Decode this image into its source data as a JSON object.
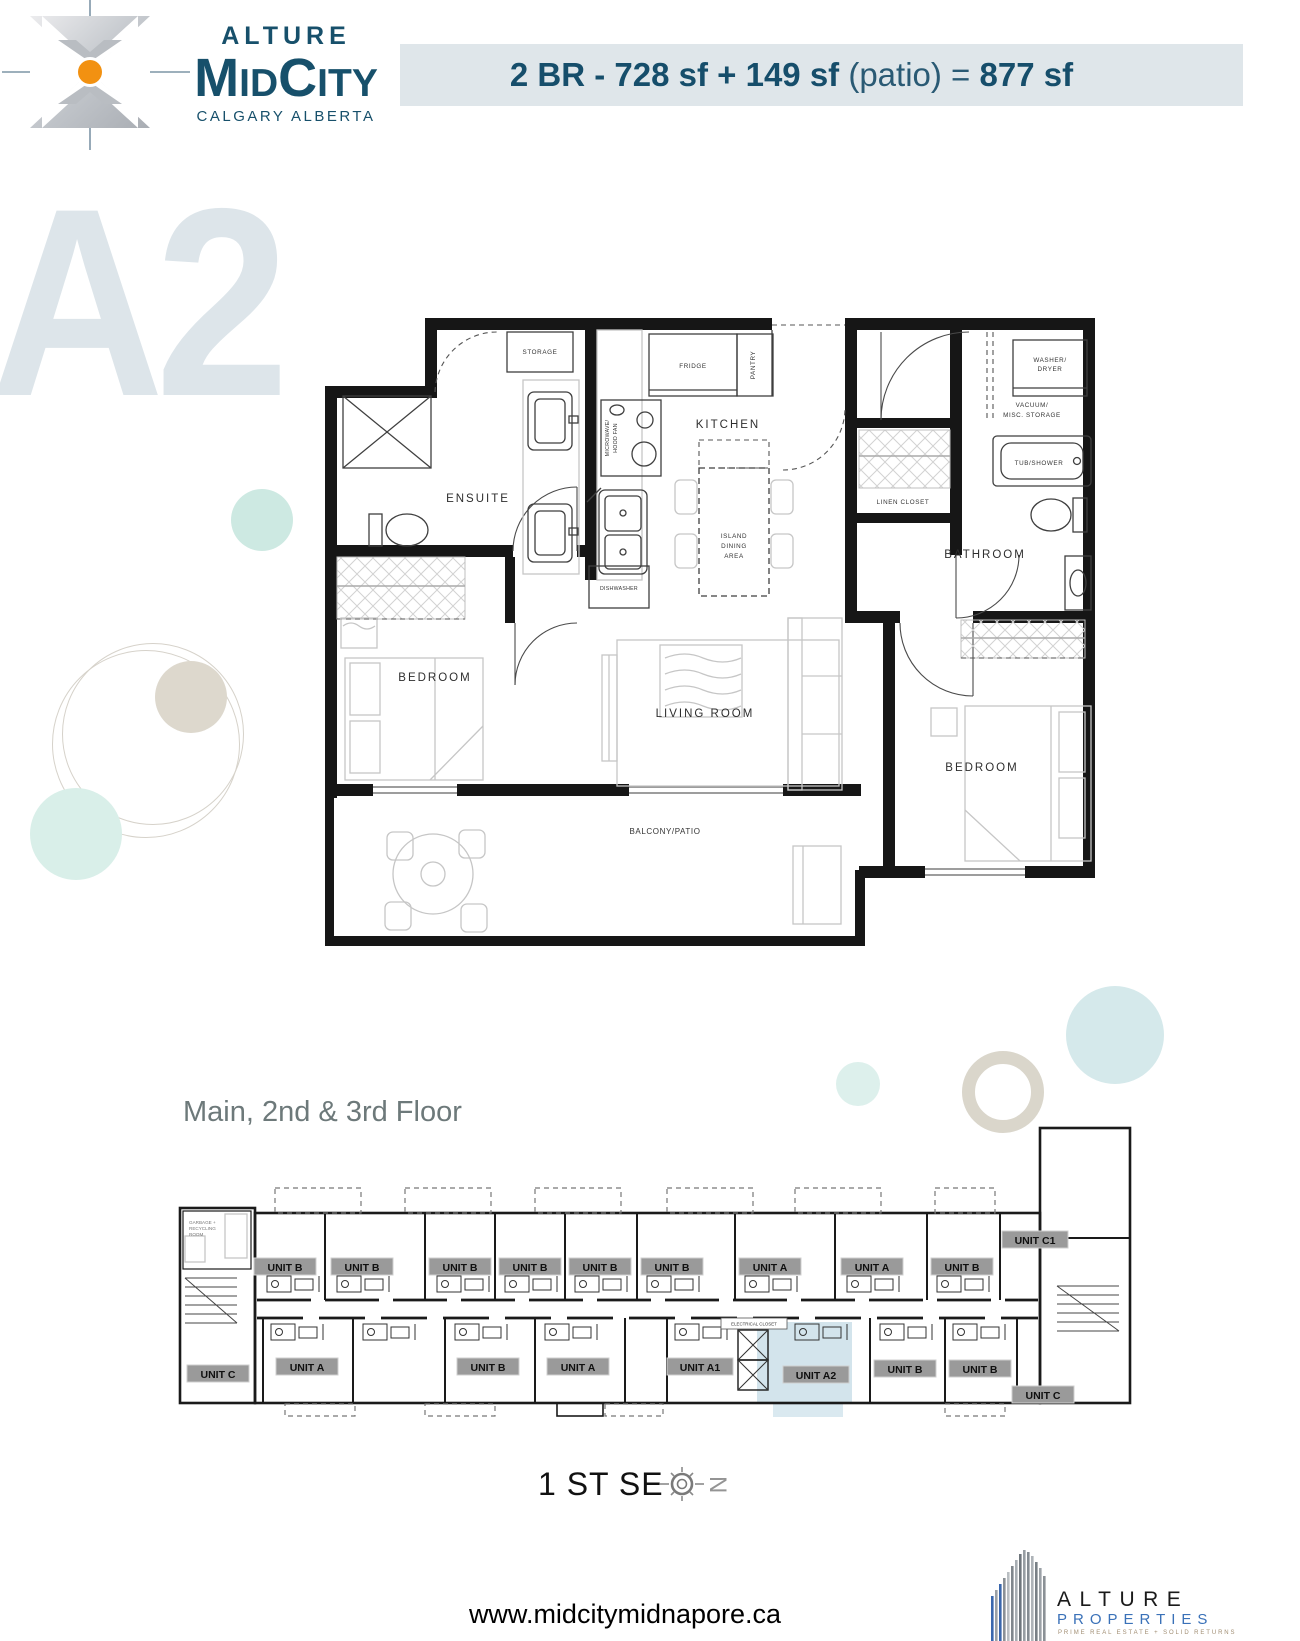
{
  "header": {
    "brand_top": "ALTURE",
    "brand_m": "M",
    "brand_id": "ID",
    "brand_c": "C",
    "brand_ity": "ITY",
    "brand_sub": "CALGARY ALBERTA",
    "banner_bold1": "2 BR - 728 sf + 149 sf",
    "banner_light": " (patio) = ",
    "banner_bold2": "877 sf"
  },
  "watermark": "A2",
  "floorplan": {
    "storage": "STORAGE",
    "fridge": "FRIDGE",
    "pantry": "PANTRY",
    "microwave": [
      "MICROWAVE/",
      "HOOD FAN"
    ],
    "kitchen": "KITCHEN",
    "island": [
      "ISLAND",
      "DINING",
      "AREA"
    ],
    "dishwasher": "DISHWASHER",
    "ensuite": "ENSUITE",
    "bedroom_left": "BEDROOM",
    "living_room": "LIVING ROOM",
    "balcony": "BALCONY/PATIO",
    "washer_dryer": [
      "WASHER/",
      "DRYER"
    ],
    "vacuum": [
      "VACUUM/",
      "MISC. STORAGE"
    ],
    "linen_closet": "LINEN CLOSET",
    "tub_shower": "TUB/SHOWER",
    "bathroom": "BATHROOM",
    "bedroom_right": "BEDROOM"
  },
  "building": {
    "title": "Main, 2nd & 3rd Floor",
    "garbage_room": [
      "GARBAGE +",
      "RECYCLING",
      "ROOM"
    ],
    "electrical_closet": "ELECTRICAL CLOSET",
    "top_units": [
      "UNIT B",
      "UNIT B",
      "UNIT B",
      "UNIT B",
      "UNIT B",
      "UNIT B",
      "UNIT A",
      "UNIT A",
      "UNIT B",
      "UNIT C1"
    ],
    "bottom_units": [
      "UNIT C",
      "UNIT A",
      "UNIT B",
      "UNIT A",
      "UNIT A1",
      "UNIT A2",
      "UNIT B",
      "UNIT B",
      "UNIT C"
    ],
    "highlighted_unit": "UNIT A2"
  },
  "footer": {
    "street": "1 ST SE",
    "north_letter": "N",
    "website": "www.midcitymidnapore.ca",
    "logo_name": "ALTURE",
    "logo_sub": "PROPERTIES",
    "logo_tagline": "PRIME REAL ESTATE + SOLID RETURNS"
  },
  "colors": {
    "brand_navy": "#17506b",
    "banner_bg": "#dfe6ea",
    "watermark": "#dde5ea",
    "badge_gray": "#9a9a9a",
    "unit_highlight": "#cbdfe9",
    "section_title_gray": "#6d797a",
    "properties_blue": "#3a71b8",
    "accent_orange": "#f29111",
    "deco_teal": "#cde9e2",
    "deco_beige": "#ddd8cd"
  }
}
